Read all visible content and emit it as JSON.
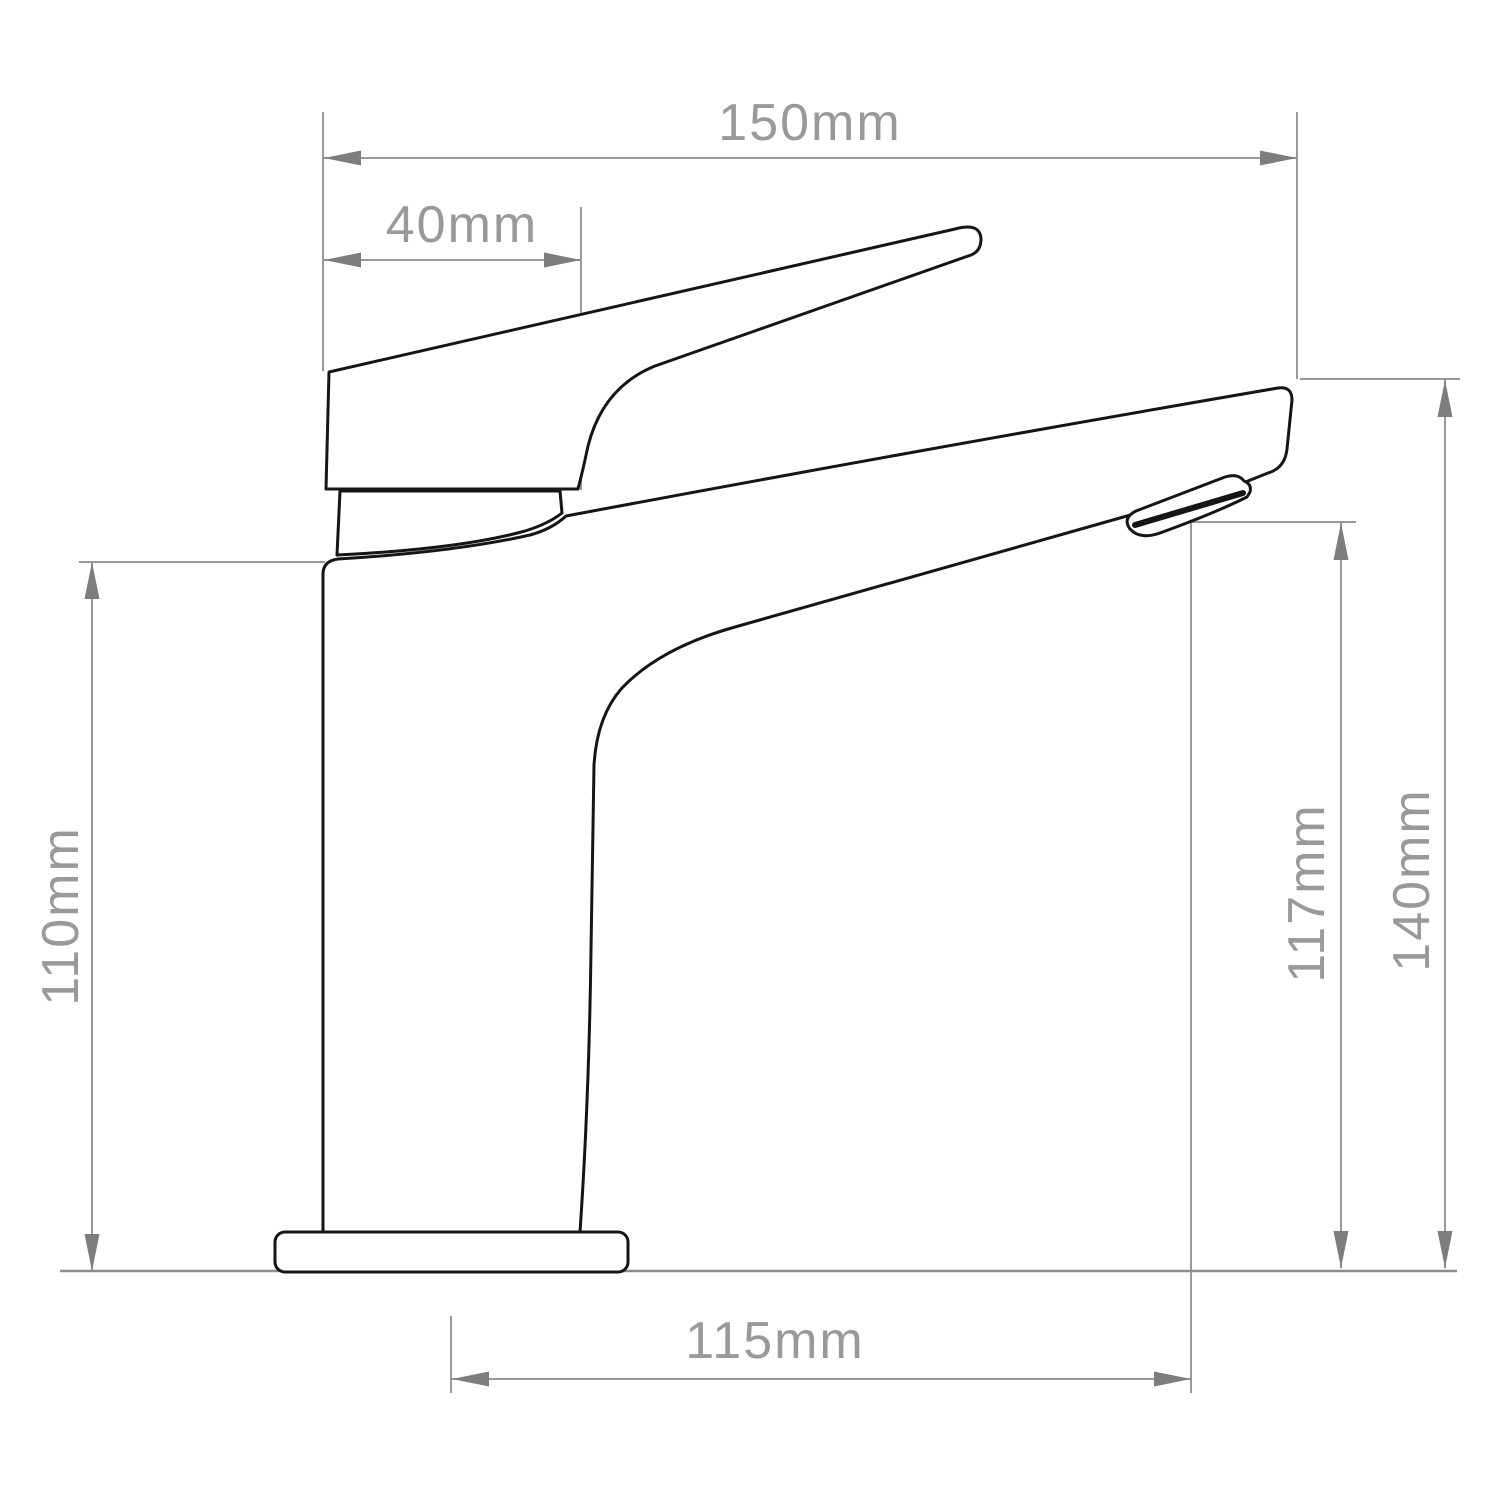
{
  "drawing": {
    "title": "Basin mixer tap — dimensioned side elevation",
    "unit": "mm",
    "colors": {
      "dimension": "#999999",
      "arrow": "#7d7d7d",
      "outline": "#151515",
      "background": "#ffffff"
    },
    "dimensions": {
      "overall_width": {
        "label": "150mm",
        "value": 150
      },
      "handle_offset": {
        "label": "40mm",
        "value": 40
      },
      "body_height": {
        "label": "110mm",
        "value": 110
      },
      "outlet_height": {
        "label": "117mm",
        "value": 117
      },
      "overall_height": {
        "label": "140mm",
        "value": 140
      },
      "spout_reach": {
        "label": "115mm",
        "value": 115
      }
    }
  }
}
